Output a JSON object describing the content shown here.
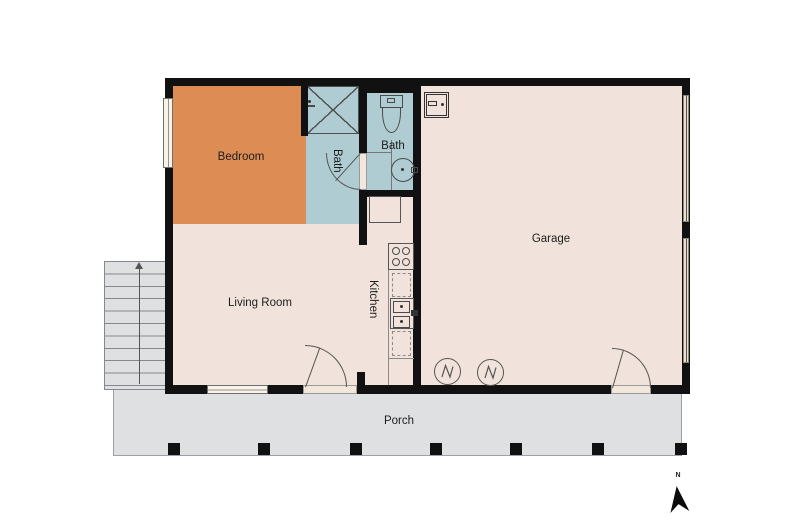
{
  "rooms": {
    "bedroom": {
      "label": "Bedroom"
    },
    "bath_shower": {
      "label": "Bath"
    },
    "bath_wc": {
      "label": "Bath"
    },
    "kitchen": {
      "label": "Kitchen"
    },
    "living_room": {
      "label": "Living Room"
    },
    "garage": {
      "label": "Garage"
    },
    "porch": {
      "label": "Porch"
    }
  },
  "compass": {
    "north_label": "N"
  },
  "colors": {
    "bedroom": "#DD8D53",
    "bath": "#AECCD2",
    "floor": "#F1E3DB",
    "outdoor": "#DEE0E2",
    "wall": "#111111",
    "background": "#FFFFFF"
  },
  "fixtures": [
    "shower",
    "toilet",
    "bathroom-sink",
    "refrigerator",
    "stove",
    "kitchen-sink",
    "dishwasher",
    "washer",
    "dryer",
    "electrical-panel",
    "stairs-up",
    "porch-posts"
  ]
}
